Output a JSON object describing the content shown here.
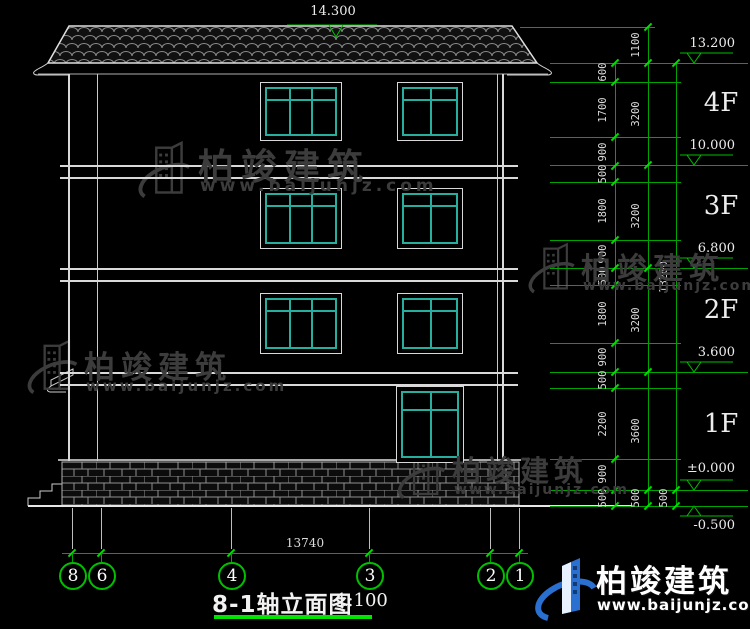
{
  "drawing": {
    "title": "8-1轴立面图",
    "scale": "1:100",
    "top_elevation": "14.300",
    "total_width_dim": "13740",
    "axis_labels": [
      "8",
      "6",
      "4",
      "3",
      "2",
      "1"
    ],
    "floor_labels": [
      "4F",
      "3F",
      "2F",
      "1F"
    ],
    "elevations": [
      "13.200",
      "10.000",
      "6.800",
      "3.600",
      "±0.000",
      "-0.500"
    ],
    "dim_chain_inner": [
      "600",
      "1700",
      "900",
      "500",
      "1800",
      "900",
      "500",
      "1800",
      "900",
      "500",
      "2200",
      "900",
      "500"
    ],
    "dim_chain_floors": [
      "1100",
      "3200",
      "3200",
      "3200",
      "3600",
      "500"
    ],
    "dim_chain_total": [
      "13200",
      "500"
    ]
  },
  "watermark": {
    "brand": "柏竣建筑",
    "url": "www.baijunjz.com"
  },
  "brand_logo": {
    "brand": "柏竣建筑",
    "url": "www.baijunjz.com"
  },
  "colors": {
    "background": "#000000",
    "line_white": "#d9d9d9",
    "dim_green": "#00c000",
    "window_cyan": "#27ae9f",
    "watermark_gray": "#3c3c3c",
    "logo_blue": "#2a70d0"
  }
}
